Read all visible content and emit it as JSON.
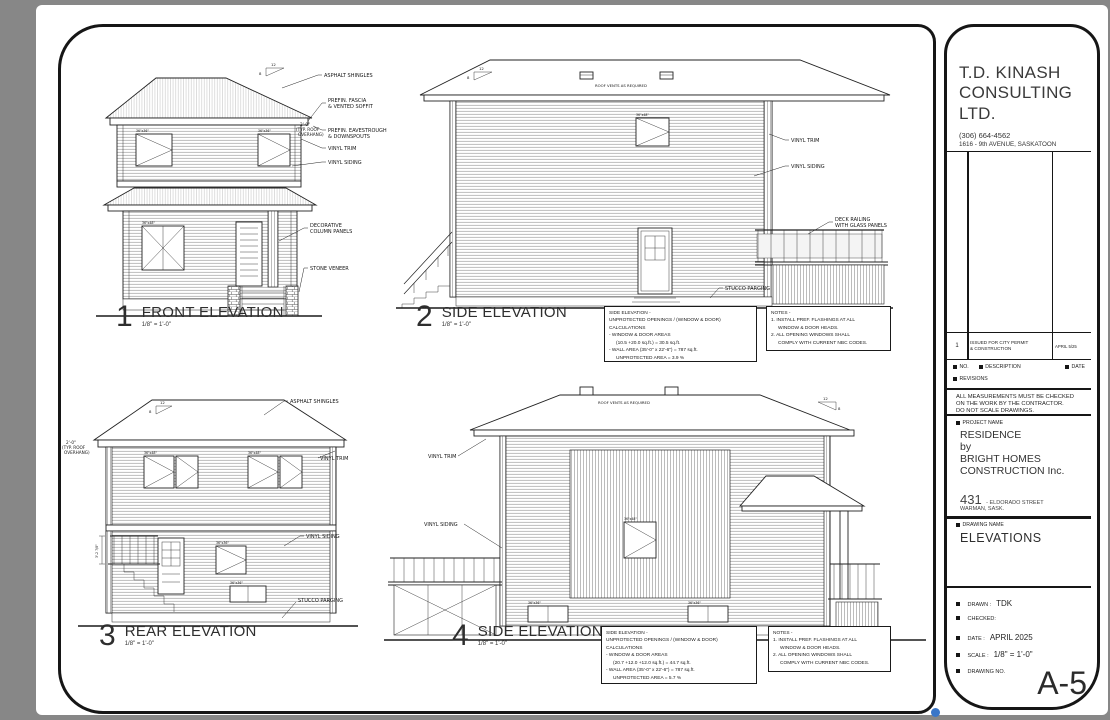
{
  "colors": {
    "background": "#878787",
    "ink": "#1f1f1f",
    "paper": "#ffffff",
    "glass": "#f4f4f4",
    "artifact_blue": "#3a76c8"
  },
  "title_block": {
    "company1": "T.D. KINASH",
    "company2": "CONSULTING",
    "company3": "LTD.",
    "phone": "(306) 664-4562",
    "address": "1616 - 9th AVENUE, SASKATOON",
    "revision": {
      "no": "1",
      "desc1": "ISSUED FOR CITY PERMIT",
      "desc2": "& CONSTRUCTION",
      "date": "APRIL 5/25"
    },
    "headers": {
      "no": "NO.",
      "description": "DESCRIPTION",
      "date": "DATE",
      "revisions": "REVISIONS"
    },
    "disclaimer1": "ALL MEASUREMENTS MUST BE CHECKED",
    "disclaimer2": "ON THE WORK BY THE CONTRACTOR.",
    "disclaimer3": "DO NOT SCALE DRAWINGS.",
    "project_name_label": "PROJECT NAME",
    "project1": "RESIDENCE",
    "project2": "by",
    "project3": "BRIGHT HOMES",
    "project4": "CONSTRUCTION Inc.",
    "street_no": "431",
    "street": "- ELDORADO STREET",
    "city": "WARMAN, SASK.",
    "drawing_name_label": "DRAWING NAME",
    "drawing_name": "ELEVATIONS",
    "drawn_label": "DRAWN :",
    "drawn": "TDK",
    "checked_label": "CHECKED:",
    "date_label": "DATE :",
    "date": "APRIL 2025",
    "scale_label": "SCALE :",
    "scale": "1/8\" = 1'-0\"",
    "drawing_no_label": "DRAWING NO.",
    "drawing_no": "A-5"
  },
  "drawings": {
    "d1": {
      "num": "1",
      "title": "FRONT ELEVATION",
      "scale": "1/8\" = 1'-0\"",
      "shingles": "ASPHALT SHINGLES",
      "fascia1": "PREFIN. FASCIA",
      "fascia2": "& VENTED SOFFIT",
      "eaves1": "PREFIN. EAVESTROUGH",
      "eaves2": "& DOWNSPOUTS",
      "trim": "VINYL TRIM",
      "siding": "VINYL SIDING",
      "column1": "DECORATIVE",
      "column2": "COLUMN PANELS",
      "stone": "STONE VENEER",
      "dim1": "2'-0\"",
      "dim2": "(TYP. ROOF",
      "dim3": "OVERHANG)",
      "rise": "12",
      "run": "8"
    },
    "d2": {
      "num": "2",
      "title": "SIDE ELEVATION",
      "scale": "1/8\" = 1'-0\"",
      "vents": "ROOF VENTS AS REQUIRED",
      "trim": "VINYL TRIM",
      "siding": "VINYL SIDING",
      "deck1": "DECK RAILING",
      "deck2": "WITH GLASS PANELS",
      "stucco": "STUCCO PARGING",
      "rise": "12",
      "run": "8"
    },
    "d3": {
      "num": "3",
      "title": "REAR ELEVATION",
      "scale": "1/8\" = 1'-0\"",
      "shingles": "ASPHALT SHINGLES",
      "trim": "VINYL TRIM",
      "siding": "VINYL SIDING",
      "stucco": "STUCCO PARGING",
      "dim1": "2'-0\"",
      "dim2": "(TYP. ROOF",
      "dim3": "OVERHANG)",
      "deck_dim": "3'-2 7/8\"",
      "rise": "12",
      "run": "8"
    },
    "d4": {
      "num": "4",
      "title": "SIDE ELEVATION",
      "scale": "1/8\" = 1'-0\"",
      "vents": "ROOF VENTS AS REQUIRED",
      "trim": "VINYL TRIM",
      "siding": "VINYL SIDING",
      "rise": "12",
      "run": "8"
    }
  },
  "window_tags": {
    "small": "36\"x36\"",
    "med": "36\"x48\""
  },
  "notes_top": {
    "title": "SIDE ELEVATION -",
    "line1": "UNPROTECTED OPENINGS / (WINDOW & DOOR) CALCULATIONS",
    "line2": "- WINDOW & DOOR AREAS",
    "line3": "(10.5 +20.0 sq.ft.) = 30.5 sq.ft.",
    "line4": "- WALL AREA (35'-0\" x 22'-6\") = 787 sq.ft.",
    "line5": "UNPROTECTED AREA = 3.9 %"
  },
  "notes_bottom": {
    "title": "SIDE ELEVATION -",
    "line1": "UNPROTECTED OPENINGS / (WINDOW & DOOR) CALCULATIONS",
    "line2": "- WINDOW & DOOR AREAS",
    "line3": "(20.7 +12.0 +12.0 sq.ft.) = 44.7 sq.ft.",
    "line4": "- WALL AREA (35'-0\" x 22'-6\") = 787 sq.ft.",
    "line5": "UNPROTECTED AREA = 5.7 %"
  },
  "general_notes": {
    "title": "NOTES -",
    "n1": "1. INSTALL PREF. FLASHINGS AT ALL",
    "n2": "WINDOW & DOOR HEADS.",
    "n3": "2. ALL OPENING WINDOWS SHALL",
    "n4": "COMPLY WITH CURRENT NBC CODES."
  }
}
